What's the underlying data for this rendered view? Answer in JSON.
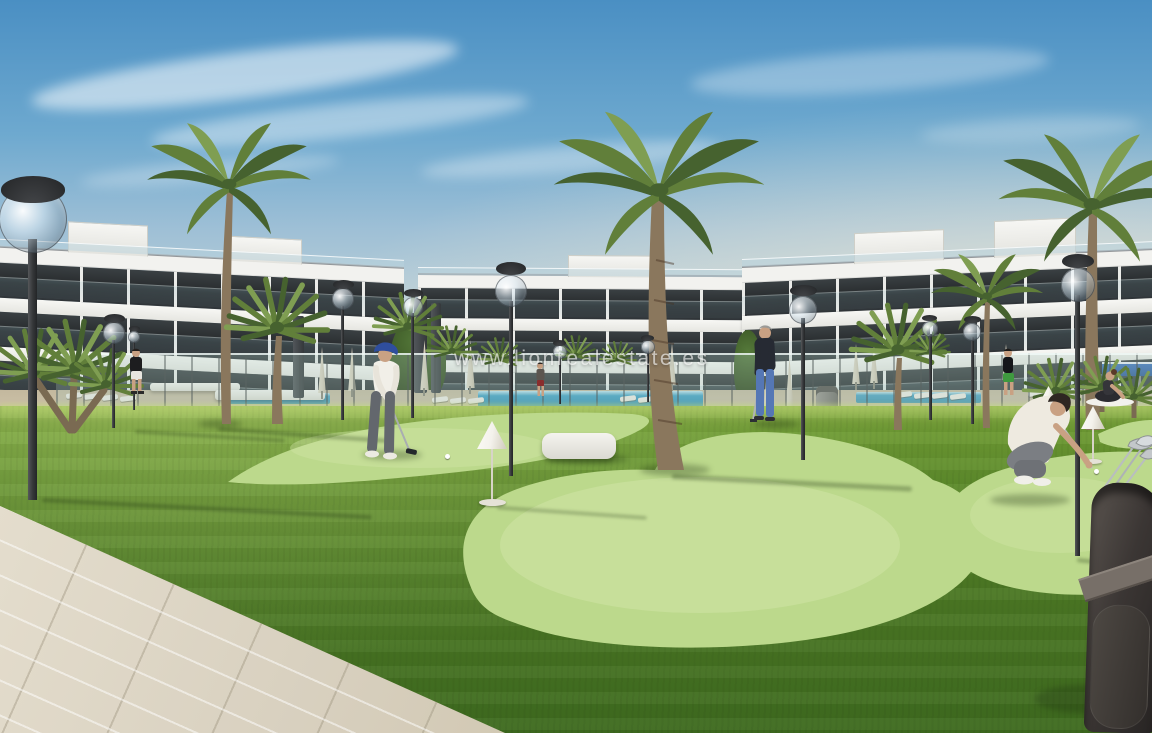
{
  "watermark": {
    "text": "www.lionrealestate.es"
  },
  "scene": {
    "type": "architectural-render",
    "objects": [
      "apartment-buildings",
      "palm-trees",
      "street-lamps",
      "glass-pool-fence",
      "swimming-pool",
      "sun-loungers",
      "closed-umbrellas",
      "putting-greens",
      "cone-markers",
      "golf-ball",
      "golf-bag",
      "person-golfer-putting",
      "person-standing-golfer",
      "person-crouching-golfer",
      "person-walking",
      "person-yoga",
      "ping-pong-table",
      "tiled-walkway"
    ]
  },
  "colors": {
    "sky_top": "#4a8fc3",
    "sky_mid": "#9fc0d6",
    "sky_horizon": "#dde3d8",
    "haze": "#ece6d6",
    "building_white": "#f2f2ef",
    "glazing_dark": "#26292b",
    "glazing_mid": "#3a4043",
    "grass_far": "#85a944",
    "grass_mid": "#5c8a2b",
    "grass_dark": "#3f6b20",
    "green_light": "#bcd98c",
    "green_highlight": "#d2e5a8",
    "path_tile": "#d8d0bf",
    "water": "#3f9fc4",
    "deck": "#cfc4aa",
    "fence_glass": "#aac8bf",
    "umbrella": "#d5ccba",
    "trunk": "#8a775d",
    "frond_dark": "#46622f",
    "frond_mid": "#617f3a",
    "frond_light": "#7f9e52",
    "lamp_metal": "#343638",
    "skin": "#c9a183",
    "cap_blue": "#2f4e9e",
    "jeans": "#5577b5",
    "bag": "#3b3634",
    "club_silver": "#c3c7ca",
    "cone_white": "#f4f2ec",
    "bench_white": "#edebe3",
    "table_blue": "#3d72bc",
    "shadow_col": "rgba(25,45,12,0.30)"
  }
}
